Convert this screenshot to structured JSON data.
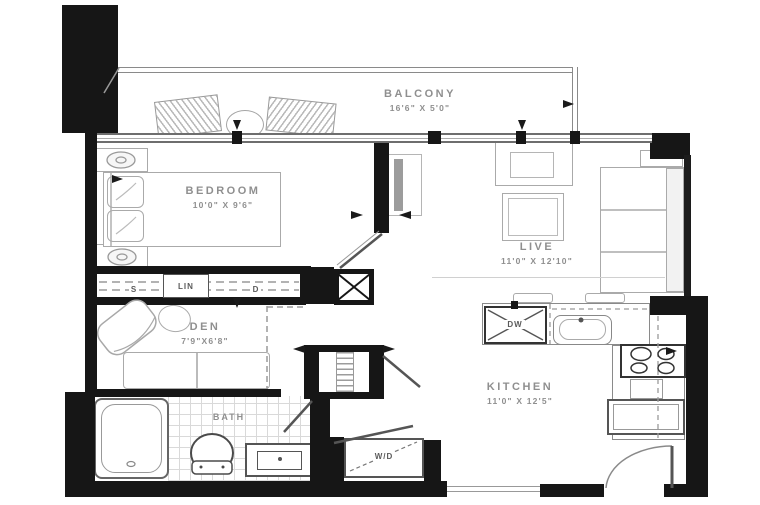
{
  "rooms": {
    "balcony": {
      "label": "BALCONY",
      "dims": "16'6\" X 5'0\""
    },
    "bedroom": {
      "label": "BEDROOM",
      "dims": "10'0\" X 9'6\""
    },
    "live": {
      "label": "LIVE",
      "dims": "11'0\" X 12'10\""
    },
    "den": {
      "label": "DEN",
      "dims": "7'9\"X6'8\""
    },
    "kitchen": {
      "label": "KITCHEN",
      "dims": "11'0\" X 12'5\""
    },
    "bath": {
      "label": "BATH"
    }
  },
  "fixtures": {
    "washer_dryer": "W/D",
    "dishwasher": "DW",
    "closet_s": "S",
    "closet_lin": "LIN",
    "closet_d": "D"
  },
  "colors": {
    "wall": "#161616",
    "outline": "#9a9a9a",
    "fixture": "#4a4a4a",
    "text": "#8f8f8f",
    "tile": "#d9d9d9",
    "background": "#ffffff"
  }
}
